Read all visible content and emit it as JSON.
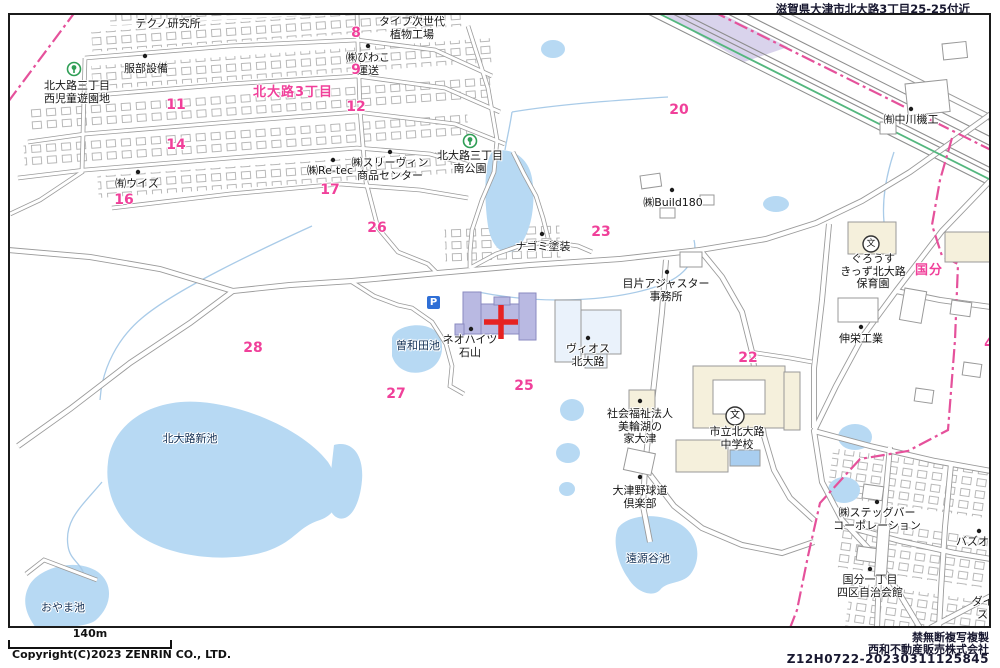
{
  "header": {
    "location_banner": "滋賀県大津市北大路3丁目25-25付近"
  },
  "footer": {
    "scale_label": "140m",
    "copyright": "Copyright(C)2023 ZENRIN CO., LTD.",
    "notice": "禁無断複写複製",
    "company": "西和不動産販売株式会社",
    "code": "Z12H0722-20230311125845"
  },
  "map": {
    "colors": {
      "water": "#b7d9f3",
      "highlight_building": "#b9b9e2",
      "pale_building": "#eaf2fb",
      "public_building": "#f5f0dc",
      "target_cross": "#e62222",
      "boundary_pink": "#e5519b",
      "route_green": "#54b77e",
      "number_pink": "#f0409a"
    },
    "icons": {
      "parking_glyph": "P",
      "school_glyph": "文"
    },
    "labels": [
      {
        "text": "テクノ研究所"
      },
      {
        "text": "服部設備"
      },
      {
        "text": "北大路三丁目\n西児童遊園地"
      },
      {
        "text": "タイプ次世代\n植物工場"
      },
      {
        "text": "㈱びわこ\n運送"
      },
      {
        "text": "㈱スリーヴィン\n商品センター"
      },
      {
        "text": "㈱Re-tec"
      },
      {
        "text": "㈲ウイズ"
      },
      {
        "text": "北大路三丁目\n南公園"
      },
      {
        "text": "ナゴミ塗装"
      },
      {
        "text": "㈱Build180"
      },
      {
        "text": "目片アジャスター\n事務所"
      },
      {
        "text": "㈲中川機工"
      },
      {
        "text": "ぐろうす\nきっず北大路\n保育園"
      },
      {
        "text": "伸栄工業"
      },
      {
        "text": "ネオハイツ\n石山"
      },
      {
        "text": "ヴィオス\n北大路"
      },
      {
        "text": "社会福祉法人\n美輪湖の\n家大津"
      },
      {
        "text": "市立北大路\n中学校"
      },
      {
        "text": "大津野球道\n倶楽部"
      },
      {
        "text": "㈱ステッグバー\nコーポレーション"
      },
      {
        "text": "国分一丁目\n四区自治会館"
      },
      {
        "text": "バズオー"
      },
      {
        "text": "ダイヤ\nスタ"
      }
    ],
    "water_labels": [
      {
        "text": "北大路新池"
      },
      {
        "text": "曽和田池"
      },
      {
        "text": "おやま池"
      },
      {
        "text": "遠源谷池"
      }
    ],
    "numbers": [
      {
        "v": "8"
      },
      {
        "v": "9"
      },
      {
        "v": "12"
      },
      {
        "v": "11"
      },
      {
        "v": "14"
      },
      {
        "v": "16"
      },
      {
        "v": "17"
      },
      {
        "v": "20"
      },
      {
        "v": "26"
      },
      {
        "v": "23"
      },
      {
        "v": "28"
      },
      {
        "v": "27"
      },
      {
        "v": "25"
      },
      {
        "v": "22"
      },
      {
        "v": "4"
      }
    ],
    "area_labels": [
      {
        "text": "北大路3丁目"
      },
      {
        "text": "国分"
      }
    ]
  }
}
